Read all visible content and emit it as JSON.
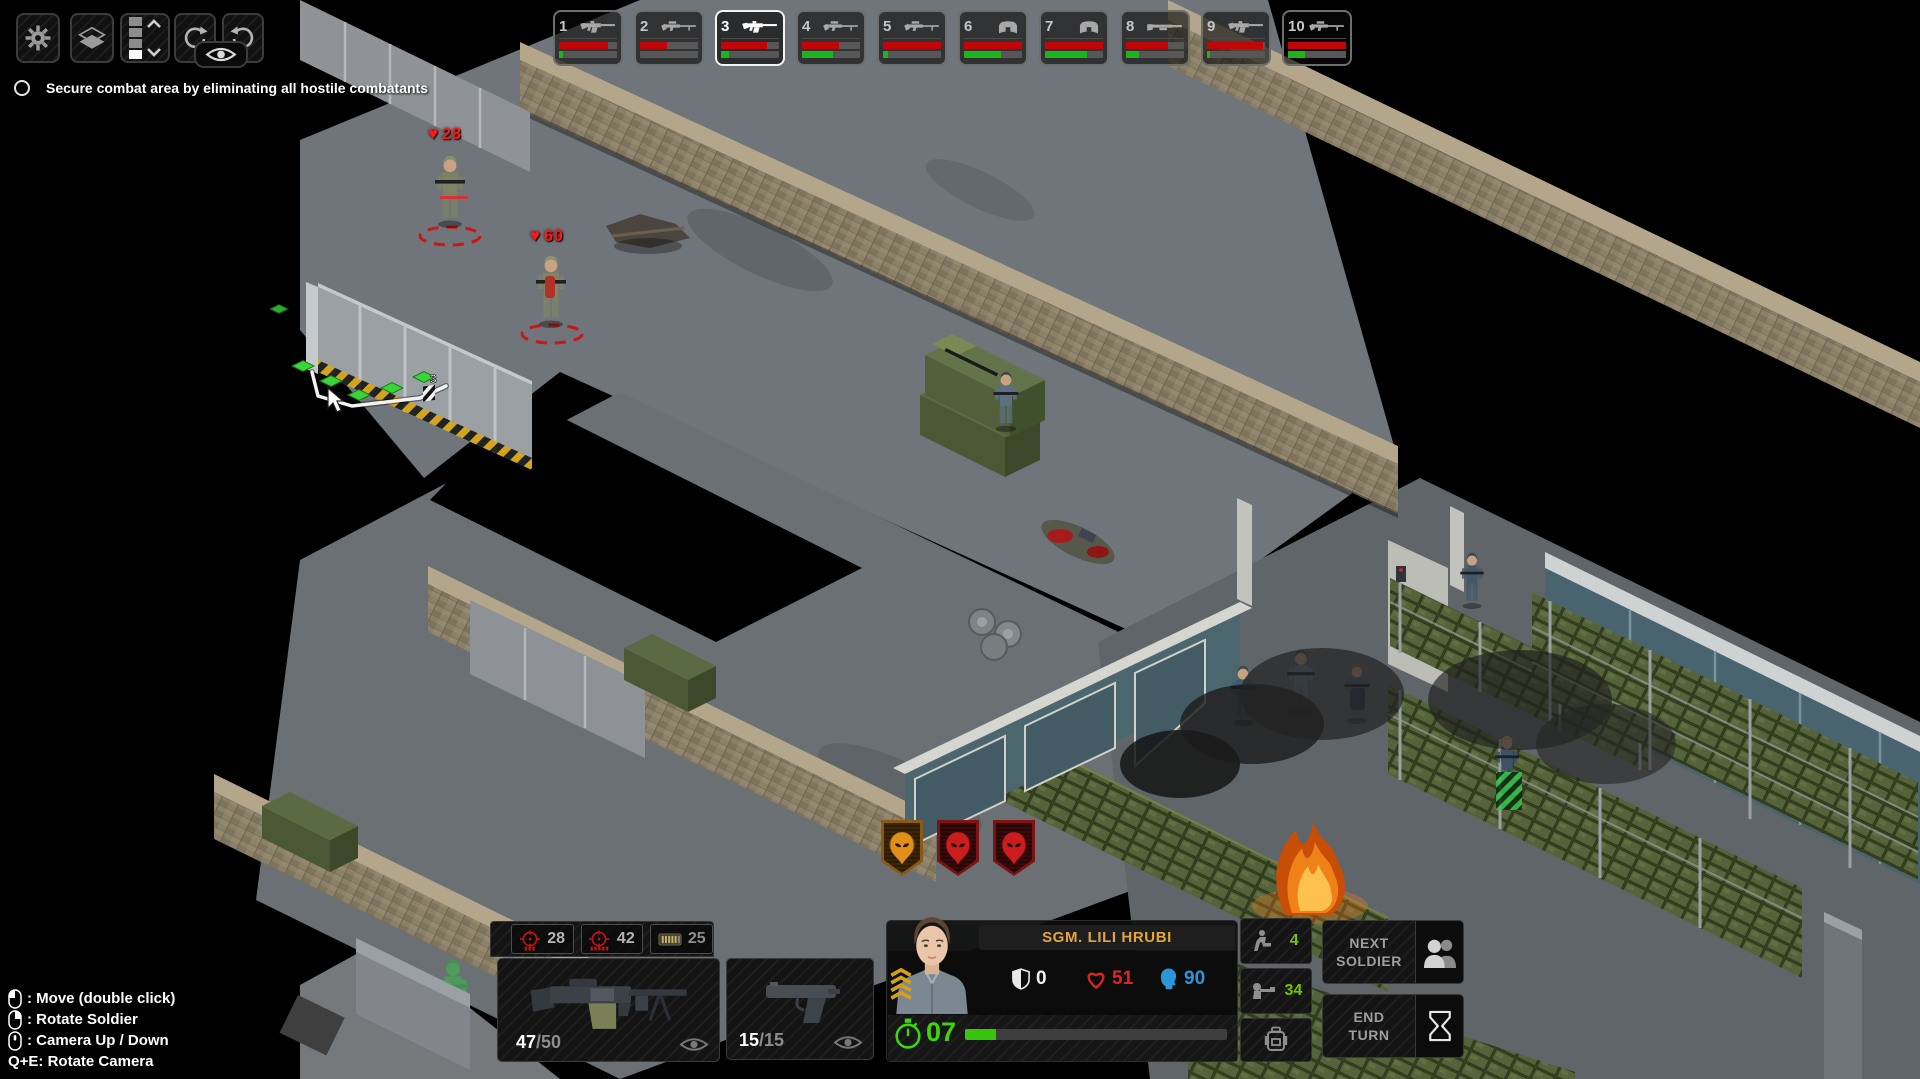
{
  "hud": {
    "toolbar": {
      "buttons": [
        {
          "id": "settings",
          "icon": "gear-icon"
        },
        {
          "id": "levels",
          "icon": "layers-icon"
        },
        {
          "id": "level-indicator",
          "cells": 4,
          "active_cell_from_bottom": 1
        },
        {
          "id": "level-up-down",
          "icon": "chevron-up-down-icon"
        },
        {
          "id": "rotate-camera-cw",
          "icon": "rotate-cw-icon"
        },
        {
          "id": "rotate-camera-ccw",
          "icon": "rotate-ccw-icon"
        },
        {
          "id": "toggle-vision",
          "icon": "eye-icon"
        }
      ]
    },
    "objective": {
      "text": "Secure combat area by eliminating all hostile combatants",
      "completed": false
    },
    "squad_bar": {
      "slots": [
        {
          "number": "1",
          "icon": "smg",
          "hp_pct": 84,
          "tu_pct": 7,
          "selected": false
        },
        {
          "number": "2",
          "icon": "sniper-rifle",
          "hp_pct": 46,
          "tu_pct": 0,
          "selected": false
        },
        {
          "number": "3",
          "icon": "assault-rifle",
          "hp_pct": 80,
          "tu_pct": 13,
          "selected": true
        },
        {
          "number": "4",
          "icon": "sniper-rifle",
          "hp_pct": 63,
          "tu_pct": 54,
          "selected": false
        },
        {
          "number": "5",
          "icon": "sniper-rifle",
          "hp_pct": 100,
          "tu_pct": 9,
          "selected": false
        },
        {
          "number": "6",
          "icon": "riot-shield",
          "hp_pct": 100,
          "tu_pct": 64,
          "selected": false
        },
        {
          "number": "7",
          "icon": "riot-shield",
          "hp_pct": 100,
          "tu_pct": 72,
          "selected": false
        },
        {
          "number": "8",
          "icon": "shotgun",
          "hp_pct": 72,
          "tu_pct": 22,
          "selected": false
        },
        {
          "number": "9",
          "icon": "assault-rifle",
          "hp_pct": 97,
          "tu_pct": 6,
          "selected": false
        },
        {
          "number": "10",
          "icon": "sniper-rifle",
          "hp_pct": 100,
          "tu_pct": 30,
          "selected": false
        }
      ]
    },
    "spotted_enemies": {
      "badges": [
        {
          "threat": "psyon",
          "color": "#d8891c"
        },
        {
          "threat": "hostile",
          "color": "#c41a1a"
        },
        {
          "threat": "hostile",
          "color": "#c41a1a"
        }
      ]
    },
    "weapon_panel": {
      "fire_modes": [
        {
          "icon": "reticle-burst",
          "value": "28"
        },
        {
          "icon": "reticle-auto",
          "value": "42"
        },
        {
          "icon": "ammo-clip",
          "value": "25"
        }
      ],
      "primary_weapon": {
        "loaded": "47",
        "capacity": "/50"
      },
      "secondary_weapon": {
        "loaded": "15",
        "capacity": "/15"
      }
    },
    "soldier_panel": {
      "name": "SGM. LILI HRUBI",
      "armor": {
        "value": "0",
        "pct": 0,
        "color": "#e8e8e8"
      },
      "health": {
        "value": "51",
        "pct": 88,
        "color": "#e32222"
      },
      "morale": {
        "value": "90",
        "pct": 97,
        "color": "#2b97d8"
      },
      "time_units": {
        "value": "07",
        "pct": 12,
        "color": "#3fd40c"
      }
    },
    "action_column": [
      {
        "icon": "kneel-icon",
        "value": "4"
      },
      {
        "icon": "reaction-fire-icon",
        "value": "34"
      },
      {
        "icon": "backpack-icon",
        "value": ""
      }
    ],
    "buttons": {
      "next_soldier": {
        "line1": "NEXT",
        "line2": "SOLDIER",
        "icon": "soldiers-icon"
      },
      "end_turn": {
        "line1": "END",
        "line2": "TURN",
        "icon": "hourglass-icon"
      }
    },
    "controls": {
      "items": [
        {
          "device": "mouse-left",
          "text": ": Move (double click)"
        },
        {
          "device": "mouse-right",
          "text": ": Rotate Soldier"
        },
        {
          "device": "mouse-middle",
          "text": ": Camera Up / Down"
        },
        {
          "device": "keys",
          "text": "Q+E: Rotate Camera"
        }
      ]
    }
  },
  "scene": {
    "enemy_health_labels": [
      {
        "hp": "28"
      },
      {
        "hp": "60"
      }
    ],
    "path_move_cost": "3"
  }
}
